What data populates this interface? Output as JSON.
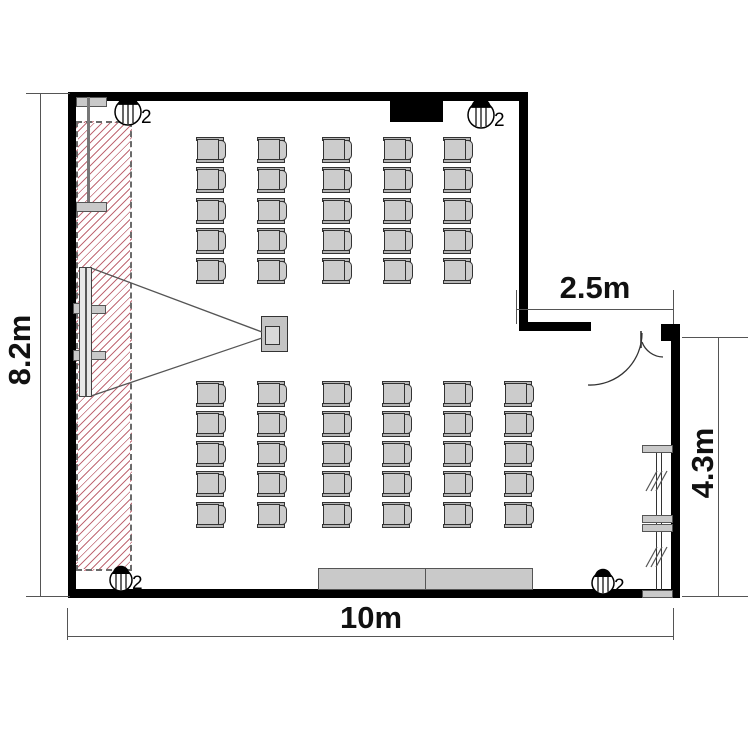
{
  "diagram": {
    "type": "floor-plan",
    "dimensions": {
      "left": "8.2m",
      "bottom": "10m",
      "top_right": "2.5m",
      "right": "4.3m"
    },
    "lights": [
      {
        "x": 128,
        "y": 112,
        "r": 13,
        "label": "2"
      },
      {
        "x": 481,
        "y": 115,
        "r": 13,
        "label": "2"
      },
      {
        "x": 121,
        "y": 580,
        "r": 11,
        "label": "2"
      },
      {
        "x": 603,
        "y": 583,
        "r": 11,
        "label": "2"
      }
    ],
    "seating": {
      "chair_size": {
        "w": 30,
        "h": 26
      },
      "total_chairs": 55,
      "blocks": [
        {
          "name": "front-block",
          "col_x": [
            196,
            257,
            322,
            383,
            443
          ],
          "row_y": [
            137,
            167,
            198,
            228,
            258
          ]
        },
        {
          "name": "rear-block",
          "col_x": [
            196,
            257,
            322,
            382,
            443,
            504
          ],
          "row_y": [
            381,
            411,
            441,
            471,
            502
          ]
        }
      ]
    },
    "shelf": {
      "tick_groups": [
        {
          "x": 646,
          "y": 481
        },
        {
          "x": 646,
          "y": 557
        }
      ]
    },
    "colors": {
      "wall": "#000000",
      "hatch_line": "#c06a76",
      "furniture": "#c9c9c9",
      "dimension": "#555555"
    }
  }
}
